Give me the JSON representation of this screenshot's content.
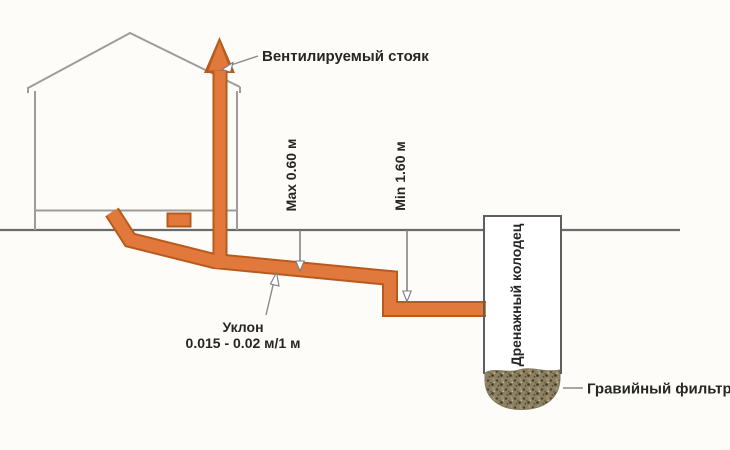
{
  "diagram": {
    "labels": {
      "vent_stack": "Вентилируемый стояк",
      "max_depth": "Max 0.60 м",
      "min_depth": "Min 1.60 м",
      "slope_title": "Уклон",
      "slope_value": "0.015 - 0.02 м/1 м",
      "drain_well": "Дренажный колодец",
      "gravel_filter": "Гравийный фильтр"
    },
    "colors": {
      "pipe": "#e0793b",
      "pipe_outline": "#b85a1c",
      "house_line": "#9c9c9c",
      "ground_line": "#6b6b6b",
      "text": "#262626",
      "background": "#fdfcf8",
      "gravel_base": "#8d8163"
    }
  }
}
